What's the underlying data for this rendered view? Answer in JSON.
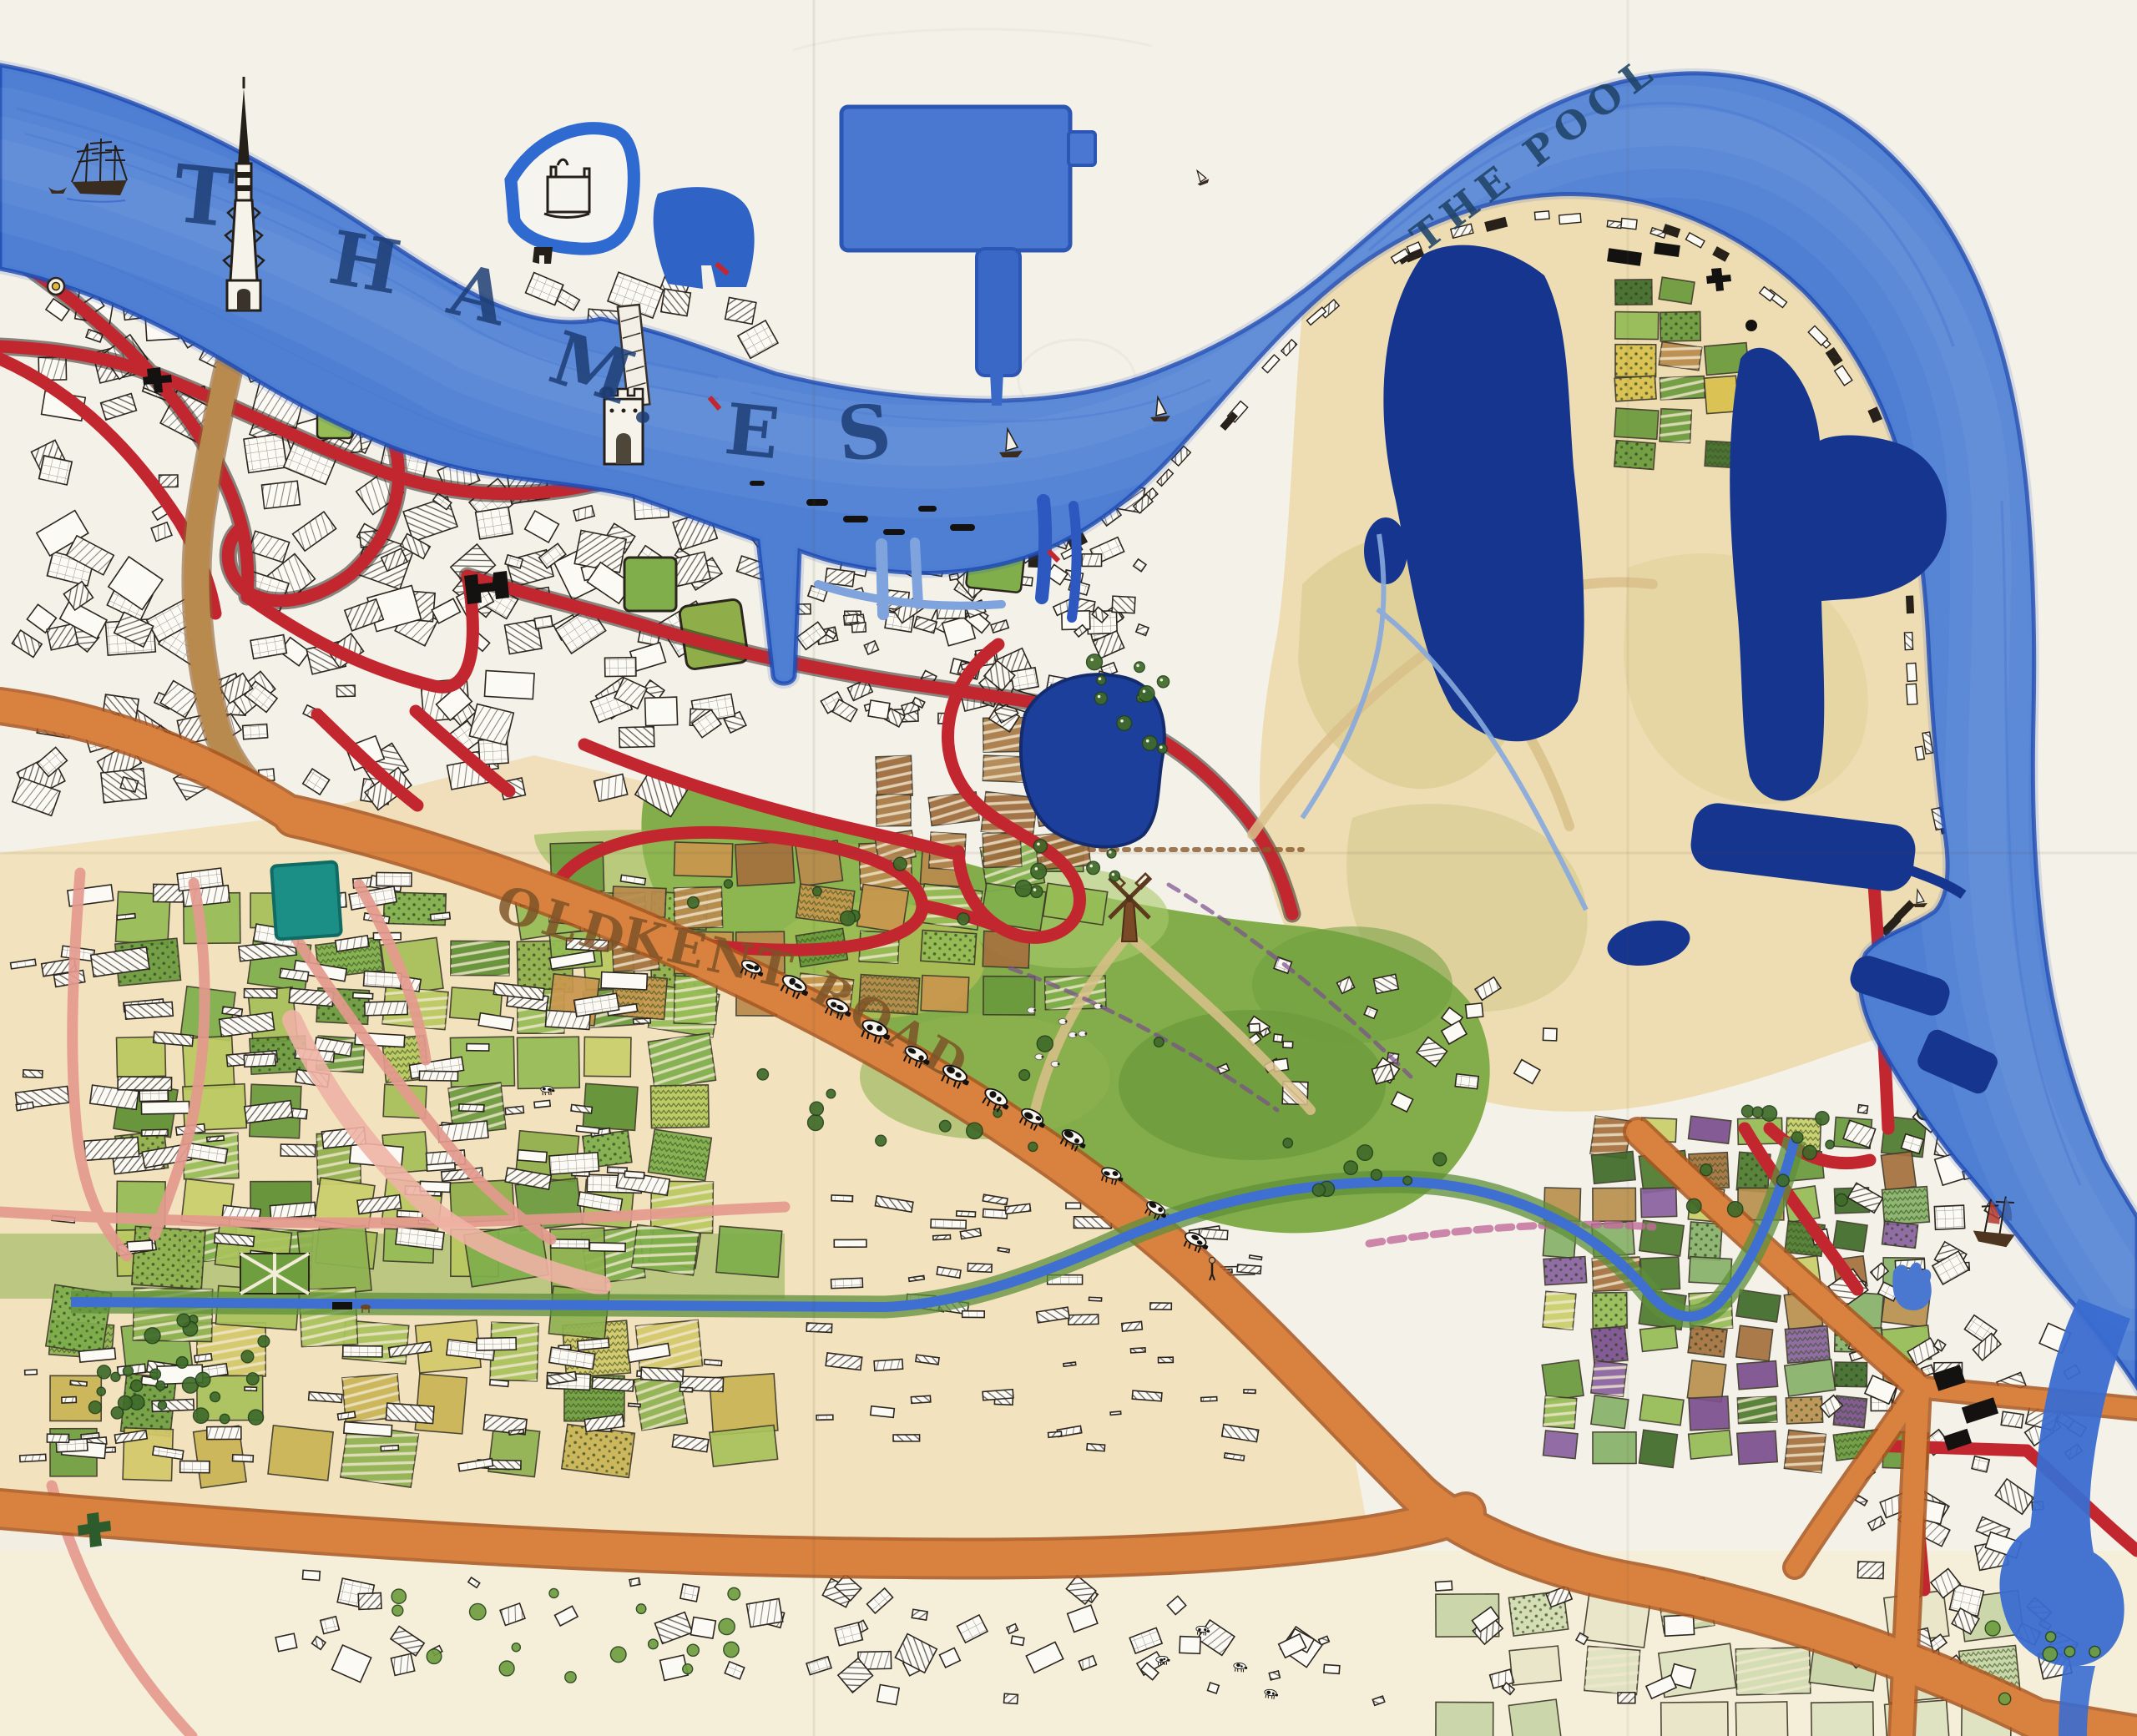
{
  "map": {
    "labels": {
      "river_letters": [
        "T",
        "H",
        "A",
        "M",
        "E",
        "S"
      ],
      "pool": "THE POOL",
      "road_words": [
        "OLD",
        "KENT",
        "ROAD"
      ]
    },
    "palette": {
      "paper": "#f4f1e8",
      "paper_cream": "#f2e2bd",
      "paper_pale": "#f5efda",
      "ink": "#2c261e",
      "label_ink": "#1c3d74",
      "pool_ink": "#1f4468",
      "road_label_ink": "#7c5226",
      "river_deep": "#2e5cc5",
      "river_mid": "#5585d8",
      "river_light": "#86aee6",
      "river_pale": "#cfe0f6",
      "river_edge": "#1e4bb2",
      "dock_navy": "#16358f",
      "dock_blue": "#4a77cf",
      "pond_navy": "#1d3f9c",
      "teal_pond": "#1b8f86",
      "canal_blue": "#3e6fd1",
      "road_red": "#c22730",
      "road_orange": "#d9823f",
      "road_orange_edge": "#aa5620",
      "road_pink": "#e49a8e",
      "road_brown": "#b98a4d",
      "grass": "#83ad4a",
      "grass_dark": "#5f8f33",
      "grass_light": "#a9c96a",
      "tree_green": "#3f6b2a",
      "cow_white": "#f8f6ef",
      "cow_black": "#141210",
      "fields_green": [
        "#7fae4b",
        "#95bc55",
        "#6a9a3c",
        "#b9c95f",
        "#8fae49",
        "#a7bf59",
        "#5e8f33",
        "#c9cf6a"
      ],
      "fields_green2": [
        "#86b24f",
        "#a9c25c",
        "#6f9e3f",
        "#c9b455",
        "#8fb251",
        "#d4c96a"
      ],
      "fields_mixNE": [
        "#7fae4b",
        "#95bc55",
        "#a4703d",
        "#b98a4d",
        "#6a9a3c",
        "#c9974e"
      ],
      "fields_plough": [
        "#9c6a3a",
        "#a87844",
        "#8a5c32",
        "#b08450"
      ],
      "fields_allot": [
        "#6a9a3c",
        "#95bc55",
        "#8a62a0",
        "#b9914e",
        "#4e7a2e",
        "#c9cf6a",
        "#7b4f8e",
        "#a4703d",
        "#88b26a",
        "#3f6b2a"
      ],
      "fields_pale": [
        "#dfe3c0",
        "#d2dcb0",
        "#e8e6c8",
        "#c8d6a6"
      ],
      "fields_wedge": [
        "#6a9a3c",
        "#d9c04e",
        "#3f6b2a",
        "#95bc55",
        "#b98a4d"
      ],
      "fields_garden": [
        "#8fb251",
        "#a9c25c",
        "#7fae4b"
      ]
    }
  }
}
